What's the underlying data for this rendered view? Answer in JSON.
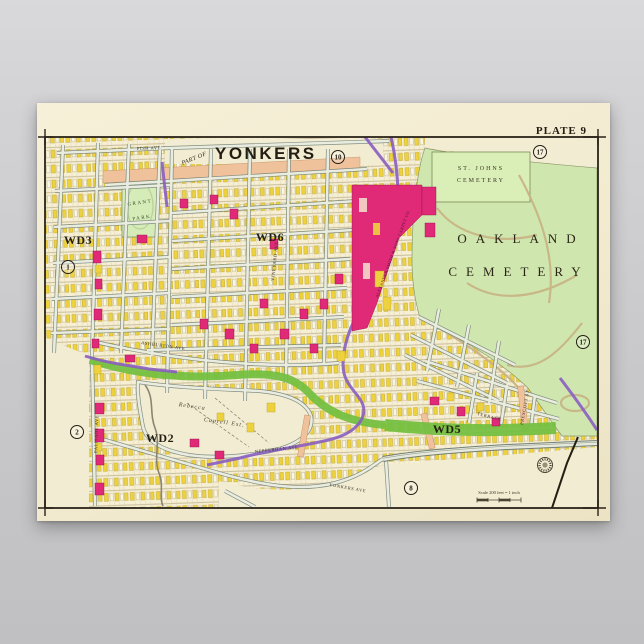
{
  "poster": {
    "plate_label": "PLATE 9",
    "title_prefix": "PART OF",
    "title": "YONKERS",
    "regions": {
      "st_johns_line1": "ST. JOHNS",
      "st_johns_line2": "CEMETERY",
      "oakland_line1": "OAKLAND",
      "oakland_line2": "CEMETERY",
      "grant_park_line1": "GRANT",
      "grant_park_line2": "PARK",
      "estate_line1": "Rebecca",
      "estate_line2": "Caprell Est."
    },
    "wards": {
      "ward3": "WD3",
      "ward6": "WD6",
      "ward2": "WD2",
      "ward5": "WD5"
    },
    "streets": {
      "fish": "FISH AVE",
      "ashburton": "ASHBURTON AVE",
      "palisade": "PALISADE AVE",
      "vineyard": "VINEYARD AVE",
      "nepperhan": "NEPPERHAN AVE",
      "yonkers_ave": "YONKERS AVE",
      "terrace": "TERRACE",
      "prescott": "PRESCOTT ST"
    },
    "labels": {
      "factory": "ALEXANDER SMITH & SONS CARPET CO."
    },
    "plate_refs": {
      "n1": "1",
      "n2": "2",
      "n8": "8",
      "n10": "10",
      "n17a": "17",
      "n17b": "17"
    },
    "scale_note": "Scale 200 feet = 1 inch",
    "colors": {
      "paper": "#f2ebd0",
      "cemetery_green": "#cfe7ae",
      "park_green": "#d6ecb8",
      "parkway_green": "#72bf3f",
      "building_yellow": "#eed23d",
      "landmark_pink": "#e02a78",
      "road_purple": "#8a5ec2",
      "street_salmon": "#f0c29c",
      "ink": "#241d12"
    }
  }
}
